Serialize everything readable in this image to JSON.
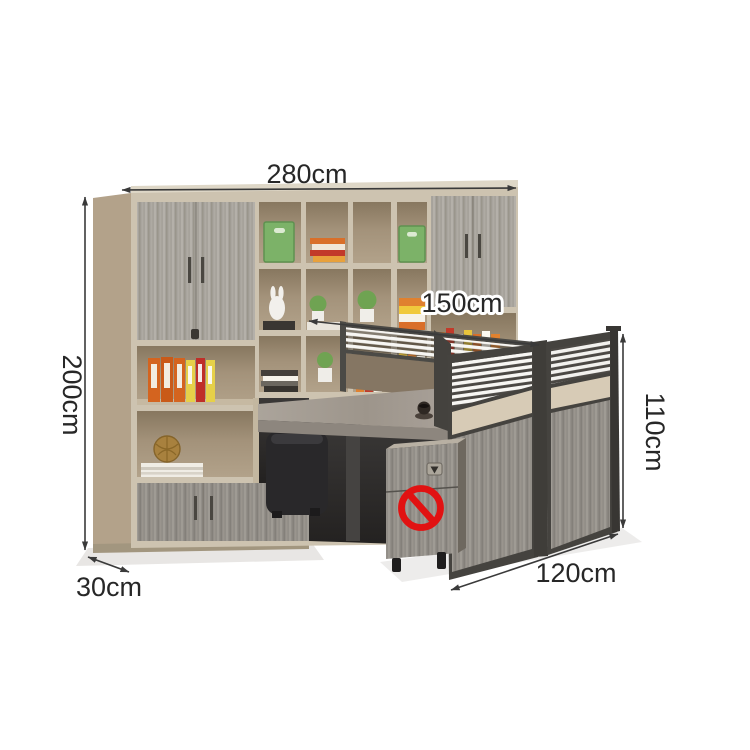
{
  "dimensions": {
    "top_width": "280cm",
    "left_height": "200cm",
    "desk_width": "150cm",
    "panel_height": "110cm",
    "cabinet_depth": "30cm",
    "desk_depth": "120cm"
  },
  "annotations": {
    "prohibition_sign": {
      "icon": "no-symbol",
      "color": "#e11212"
    }
  },
  "palette": {
    "frame_cream": "#cdc3b0",
    "side_tan": "#b3a28a",
    "shelf_back": "#9c8c76",
    "wood_gray": "#a6a29b",
    "wood_gray_dark": "#928e88",
    "beige_band": "#d7cbb6",
    "screen_frame": "#45433f",
    "desktop": "#a09890",
    "binder_orange": "#d4641f",
    "binder_yellow": "#e6d049",
    "binder_red": "#bf2f28",
    "box_green": "#7cb268",
    "dimension_ink": "#3a3a3a"
  }
}
